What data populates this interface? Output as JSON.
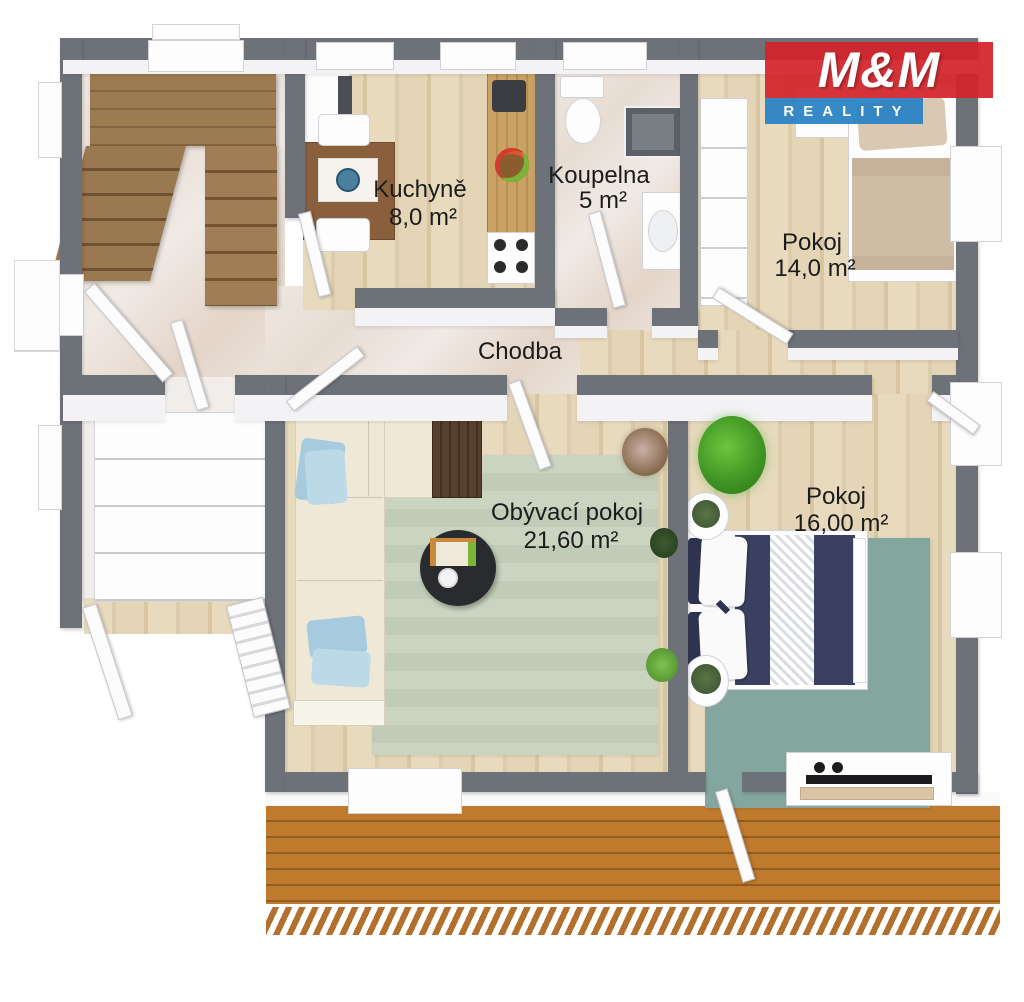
{
  "logo": {
    "title": "M&M",
    "subtitle": "REALITY"
  },
  "rooms": {
    "kuchyne": {
      "name": "Kuchyně",
      "area": "8,0 m²"
    },
    "koupelna": {
      "name": "Koupelna",
      "area": "5 m²"
    },
    "pokoj14": {
      "name": "Pokoj",
      "area": "14,0 m²"
    },
    "chodba": {
      "name": "Chodba"
    },
    "obyvaci": {
      "name": "Obývací pokoj",
      "area": "21,60 m²"
    },
    "pokoj16": {
      "name": "Pokoj",
      "area": "16,00 m²"
    }
  },
  "colors": {
    "wall": "#6d7278",
    "wood_floor": "#e5d6b8",
    "marble_floor": "#ebe3dc",
    "stair_wood": "#96744c",
    "terrace_wood": "#c07a2e",
    "living_rug": "#c9d3c0",
    "bedroom_rug": "#83a79e",
    "sofa": "#efe8d7",
    "pillow_blue": "#a6cade",
    "bed_navy": "#3a4060",
    "logo_red": "#d2232a",
    "logo_blue": "#2b84c4"
  }
}
